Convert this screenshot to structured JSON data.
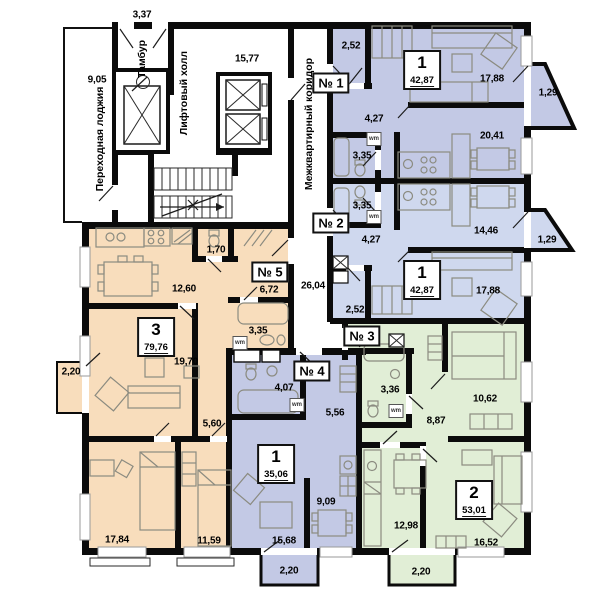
{
  "title": "Residential floor plan",
  "colors": {
    "wall": "#0b0b0b",
    "apt_blue": "#c3c9e5",
    "apt_lightblue": "#cfd8ee",
    "apt_green": "#e1eed6",
    "apt_peach": "#f8ddbc"
  },
  "common_areas": {
    "loggia": {
      "label": "Переходная лоджия",
      "area": "9,05"
    },
    "vestibule": {
      "label": "Тамбур",
      "opening_dim": "3,37"
    },
    "lift_hall": {
      "label": "Лифтовый холл",
      "area": "15,77"
    },
    "corridor": {
      "label": "Межквартирный коридор",
      "area": "26,04"
    }
  },
  "apartments": [
    {
      "badge": "№ 1",
      "rooms_count": "1",
      "total_area": "42,87",
      "room_areas": [
        "2,52",
        "17,88",
        "4,27",
        "3,35",
        "20,41"
      ],
      "balcony": "1,29",
      "color": "#c3c9e5"
    },
    {
      "badge": "№ 2",
      "rooms_count": "1",
      "total_area": "42,87",
      "room_areas": [
        "3,35",
        "14,46",
        "4,27",
        "2,52",
        "17,88"
      ],
      "balcony": "1,29",
      "color": "#cfd8ee"
    },
    {
      "badge": "№ 3",
      "rooms_count": "2",
      "total_area": "53,01",
      "room_areas": [
        "3,36",
        "10,62",
        "8,87",
        "12,98",
        "16,52"
      ],
      "balcony": "2,20",
      "color": "#e1eed6"
    },
    {
      "badge": "№ 4",
      "rooms_count": "1",
      "total_area": "35,06",
      "room_areas": [
        "4,07",
        "5,56",
        "9,09",
        "15,68"
      ],
      "balcony": "2,20",
      "color": "#c3c9e5"
    },
    {
      "badge": "№ 5",
      "rooms_count": "3",
      "total_area": "79,76",
      "room_areas": [
        "12,60",
        "1,70",
        "6,72",
        "3,35",
        "19,70",
        "5,60",
        "17,84",
        "11,59"
      ],
      "balcony": "2,20",
      "color": "#f8ddbc"
    }
  ],
  "render": {
    "vlabels": [
      {
        "t": "Переходная лоджия",
        "x": 100,
        "y": 139,
        "name": "loggia-label"
      },
      {
        "t": "Тамбур",
        "x": 142,
        "y": 59,
        "name": "vestibule-label"
      },
      {
        "t": "Лифтовый холл",
        "x": 184,
        "y": 93,
        "name": "lift-hall-label"
      },
      {
        "t": "Межквартирный коридор",
        "x": 309,
        "y": 124,
        "name": "corridor-label"
      }
    ],
    "dims": [
      {
        "t": "3,37",
        "x": 142,
        "y": 15
      },
      {
        "t": "9,05",
        "x": 97,
        "y": 80
      },
      {
        "t": "15,77",
        "x": 247,
        "y": 59
      },
      {
        "t": "2,52",
        "x": 351,
        "y": 46
      },
      {
        "t": "17,88",
        "x": 492,
        "y": 79
      },
      {
        "t": "1,29",
        "x": 548,
        "y": 93
      },
      {
        "t": "4,27",
        "x": 374,
        "y": 119
      },
      {
        "t": "3,35",
        "x": 362,
        "y": 156
      },
      {
        "t": "20,41",
        "x": 492,
        "y": 136
      },
      {
        "t": "3,35",
        "x": 362,
        "y": 206
      },
      {
        "t": "14,46",
        "x": 486,
        "y": 231
      },
      {
        "t": "4,27",
        "x": 371,
        "y": 240
      },
      {
        "t": "1,29",
        "x": 547,
        "y": 240
      },
      {
        "t": "26,04",
        "x": 313,
        "y": 286
      },
      {
        "t": "17,88",
        "x": 488,
        "y": 291
      },
      {
        "t": "2,52",
        "x": 355,
        "y": 310
      },
      {
        "t": "12,60",
        "x": 184,
        "y": 289
      },
      {
        "t": "1,70",
        "x": 216,
        "y": 250
      },
      {
        "t": "6,72",
        "x": 269,
        "y": 290
      },
      {
        "t": "3,35",
        "x": 258,
        "y": 331
      },
      {
        "t": "19,70",
        "x": 186,
        "y": 362
      },
      {
        "t": "2,20",
        "x": 71,
        "y": 372
      },
      {
        "t": "5,60",
        "x": 212,
        "y": 424
      },
      {
        "t": "17,84",
        "x": 117,
        "y": 540
      },
      {
        "t": "11,59",
        "x": 209,
        "y": 541
      },
      {
        "t": "4,07",
        "x": 284,
        "y": 388
      },
      {
        "t": "5,56",
        "x": 335,
        "y": 413
      },
      {
        "t": "9,09",
        "x": 326,
        "y": 502
      },
      {
        "t": "15,68",
        "x": 284,
        "y": 541
      },
      {
        "t": "2,20",
        "x": 289,
        "y": 571
      },
      {
        "t": "3,36",
        "x": 390,
        "y": 390
      },
      {
        "t": "10,62",
        "x": 485,
        "y": 399
      },
      {
        "t": "8,87",
        "x": 436,
        "y": 421
      },
      {
        "t": "12,98",
        "x": 406,
        "y": 526
      },
      {
        "t": "16,52",
        "x": 486,
        "y": 543
      },
      {
        "t": "2,20",
        "x": 421,
        "y": 572
      }
    ],
    "badges": [
      {
        "t": "№ 1",
        "x": 331,
        "y": 83
      },
      {
        "t": "№ 2",
        "x": 331,
        "y": 223
      },
      {
        "t": "№ 3",
        "x": 362,
        "y": 336
      },
      {
        "t": "№ 4",
        "x": 312,
        "y": 371
      },
      {
        "t": "№ 5",
        "x": 270,
        "y": 272
      }
    ],
    "cards": [
      {
        "n": "1",
        "a": "42,87",
        "x": 422,
        "y": 70
      },
      {
        "n": "1",
        "a": "42,87",
        "x": 422,
        "y": 280
      },
      {
        "n": "2",
        "a": "53,01",
        "x": 474,
        "y": 500
      },
      {
        "n": "1",
        "a": "35,06",
        "x": 276,
        "y": 464
      },
      {
        "n": "3",
        "a": "79,76",
        "x": 156,
        "y": 337
      }
    ],
    "wm": [
      {
        "t": "wm",
        "x": 374,
        "y": 139
      },
      {
        "t": "wm",
        "x": 374,
        "y": 217
      },
      {
        "t": "wm",
        "x": 240,
        "y": 343
      },
      {
        "t": "wm",
        "x": 297,
        "y": 405
      },
      {
        "t": "wm",
        "x": 396,
        "y": 411
      }
    ]
  }
}
